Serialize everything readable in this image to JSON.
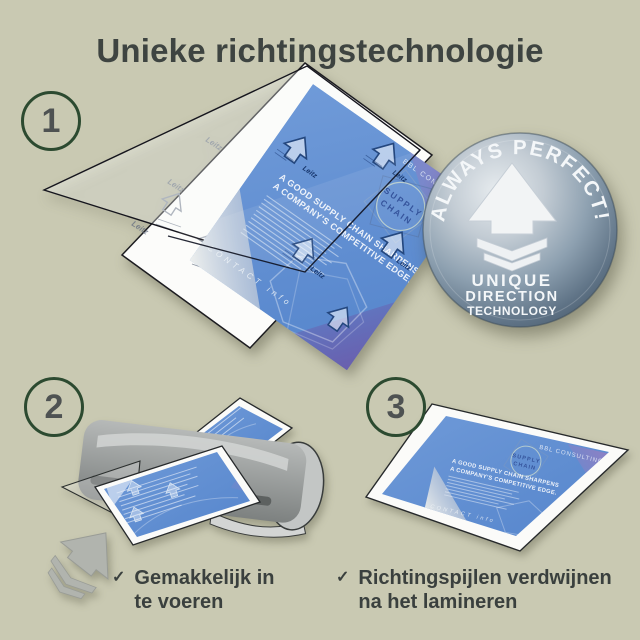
{
  "title": "Unieke richtingstechnologie",
  "steps": [
    "1",
    "2",
    "3"
  ],
  "badge": {
    "arc_text": "ALWAYS PERFECT!",
    "line1": "UNIQUE",
    "line2": "DIRECTION",
    "line3": "TECHNOLOGY",
    "arrow_icon": "up-arrow-with-chevrons"
  },
  "document": {
    "brand": "BBL CONSULTING",
    "logo_word1": "SUPPLY",
    "logo_word2": "CHAIN",
    "headline_line1": "A GOOD SUPPLY CHAIN SHARPENS",
    "headline_line2": "A COMPANY'S COMPETITIVE EDGE.",
    "footer": "CONTACT info",
    "pouch_brand": "Leitz"
  },
  "checklist": [
    {
      "icon": "checkmark-icon",
      "text": "Gemakkelijk in te voeren"
    },
    {
      "icon": "checkmark-icon",
      "text": "Richtingspijlen verdwijnen na het lamineren"
    }
  ],
  "colors": {
    "background": "#c9c9b2",
    "title_text": "#3e4441",
    "step_circle_border": "#2c4a30",
    "step_number": "#4e5252",
    "document_blue": "#5f8fd2",
    "document_purple": "#8d80c4",
    "document_indigo": "#6a5fae",
    "badge_light": "#e7ecef",
    "badge_dark": "#4a5c6d",
    "machine_gray": "#9a9d9c",
    "feed_arrow_gray": "#b1b4ae",
    "checklist_text": "#3a403e"
  }
}
